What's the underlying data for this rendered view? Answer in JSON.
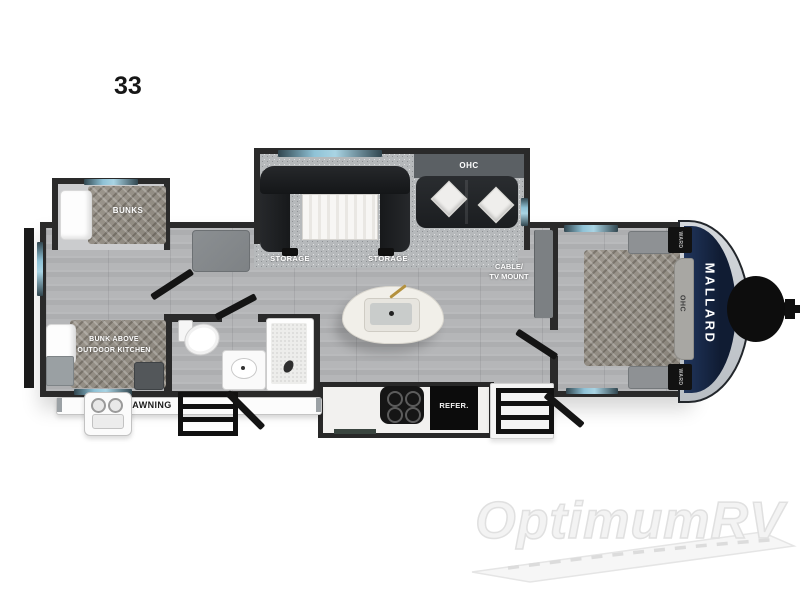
{
  "plan": {
    "model_number": "33",
    "brand": "MALLARD",
    "labels": {
      "bunks": "BUNKS",
      "storage": "STORAGE",
      "ohc": "OHC",
      "ohc_bedroom": "OHC",
      "cable_tv_line1": "CABLE/",
      "cable_tv_line2": "TV MOUNT",
      "rear_bunk_line1": "BUNK ABOVE",
      "rear_bunk_line2": "OUTDOOR KITCHEN",
      "awning": "AWNING",
      "refrigerator": "REFER.",
      "wardrobe": "WARD"
    },
    "colors": {
      "wall": "#2a2a2a",
      "front_cap_navy": "#16243c",
      "front_cap_silver": "#c9ced3",
      "window_blue": "#8fc2d6",
      "floor_gray": "#b2b3b5",
      "carpet_gray": "#b6b9bb",
      "sofa_black": "#1a1c1e",
      "counter_white": "#f2f1ef"
    }
  },
  "watermark": {
    "text": "OptimumRV"
  }
}
